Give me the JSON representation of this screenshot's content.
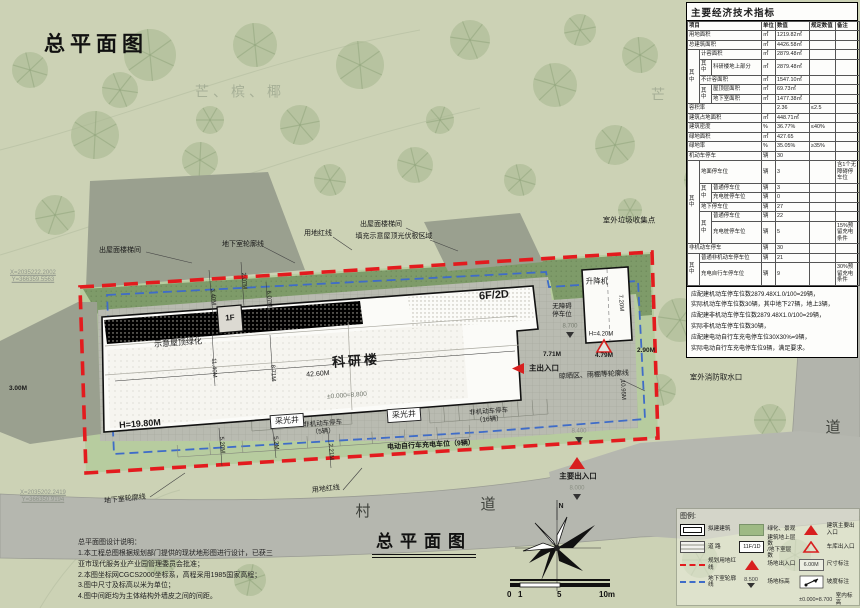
{
  "titles": {
    "top": "总平面图",
    "bottom": "总平面图"
  },
  "colors": {
    "boundary_red": "#e31b1e",
    "basement_blue": "#3f6cc8",
    "marker_red": "#d81f1f",
    "green_band": "#7e9b69",
    "paving_gray": "#b9bbb1"
  },
  "table": {
    "title": "主要经济技术指标",
    "rows": [
      {
        "h": 1,
        "c": [
          {
            "t": "项目",
            "cs": 3
          },
          {
            "t": "单位"
          },
          {
            "t": "数值"
          },
          {
            "t": "规定数值"
          },
          {
            "t": "备注"
          }
        ]
      },
      {
        "c": [
          {
            "t": "用地面积",
            "cs": 3
          },
          {
            "t": "㎡"
          },
          {
            "t": "1219.82㎡"
          },
          {
            "t": ""
          },
          {
            "t": ""
          }
        ]
      },
      {
        "c": [
          {
            "t": "总建筑面积",
            "cs": 3
          },
          {
            "t": "㎡"
          },
          {
            "t": "4426.58㎡"
          },
          {
            "t": ""
          },
          {
            "t": ""
          }
        ]
      },
      {
        "c": [
          {
            "t": "其中",
            "rs": 5
          },
          {
            "t": "计容面积",
            "cs": 2
          },
          {
            "t": "㎡"
          },
          {
            "t": "2879.48㎡"
          },
          {
            "t": ""
          },
          {
            "t": ""
          }
        ]
      },
      {
        "c": [
          {
            "t": "其中"
          },
          {
            "t": "科研楼地上部分"
          },
          {
            "t": "㎡"
          },
          {
            "t": "2879.48㎡"
          },
          {
            "t": ""
          },
          {
            "t": ""
          }
        ]
      },
      {
        "c": [
          {
            "t": "不计容面积",
            "cs": 2
          },
          {
            "t": "㎡"
          },
          {
            "t": "1547.10㎡"
          },
          {
            "t": ""
          },
          {
            "t": ""
          }
        ]
      },
      {
        "c": [
          {
            "t": "其中",
            "rs": 2
          },
          {
            "t": "屋顶层面积"
          },
          {
            "t": "㎡"
          },
          {
            "t": "69.73㎡"
          },
          {
            "t": ""
          },
          {
            "t": ""
          }
        ]
      },
      {
        "c": [
          {
            "t": "地下室面积"
          },
          {
            "t": "㎡"
          },
          {
            "t": "1477.38㎡"
          },
          {
            "t": ""
          },
          {
            "t": ""
          }
        ]
      },
      {
        "c": [
          {
            "t": "容积率",
            "cs": 3
          },
          {
            "t": ""
          },
          {
            "t": "2.36"
          },
          {
            "t": "≤2.5"
          },
          {
            "t": ""
          }
        ]
      },
      {
        "c": [
          {
            "t": "建筑占地面积",
            "cs": 3
          },
          {
            "t": "㎡"
          },
          {
            "t": "448.71㎡"
          },
          {
            "t": ""
          },
          {
            "t": ""
          }
        ]
      },
      {
        "c": [
          {
            "t": "建筑密度",
            "cs": 3
          },
          {
            "t": "%"
          },
          {
            "t": "36.77%"
          },
          {
            "t": "≤40%"
          },
          {
            "t": ""
          }
        ]
      },
      {
        "c": [
          {
            "t": "绿地面积",
            "cs": 3
          },
          {
            "t": "㎡"
          },
          {
            "t": "427.65"
          },
          {
            "t": ""
          },
          {
            "t": ""
          }
        ]
      },
      {
        "c": [
          {
            "t": "绿地率",
            "cs": 3
          },
          {
            "t": "%"
          },
          {
            "t": "35.05%"
          },
          {
            "t": "≥35%"
          },
          {
            "t": ""
          }
        ]
      },
      {
        "c": [
          {
            "t": "机动车停车",
            "cs": 3
          },
          {
            "t": "辆"
          },
          {
            "t": "30"
          },
          {
            "t": ""
          },
          {
            "t": ""
          }
        ]
      },
      {
        "c": [
          {
            "t": "其中",
            "rs": 6
          },
          {
            "t": "地面停车位",
            "cs": 2
          },
          {
            "t": "辆"
          },
          {
            "t": "3"
          },
          {
            "t": ""
          },
          {
            "t": "含1个无障碍停车位"
          }
        ]
      },
      {
        "c": [
          {
            "t": "其中",
            "rs": 2
          },
          {
            "t": "普通停车位"
          },
          {
            "t": "辆"
          },
          {
            "t": "3"
          },
          {
            "t": ""
          },
          {
            "t": ""
          }
        ]
      },
      {
        "c": [
          {
            "t": "充电桩停车位"
          },
          {
            "t": "辆"
          },
          {
            "t": "0"
          },
          {
            "t": ""
          },
          {
            "t": ""
          }
        ]
      },
      {
        "c": [
          {
            "t": "地下停车位",
            "cs": 2
          },
          {
            "t": "辆"
          },
          {
            "t": "27"
          },
          {
            "t": ""
          },
          {
            "t": ""
          }
        ]
      },
      {
        "c": [
          {
            "t": "其中",
            "rs": 2
          },
          {
            "t": "普通停车位"
          },
          {
            "t": "辆"
          },
          {
            "t": "22"
          },
          {
            "t": ""
          },
          {
            "t": ""
          }
        ]
      },
      {
        "c": [
          {
            "t": "充电桩停车位"
          },
          {
            "t": "辆"
          },
          {
            "t": "5"
          },
          {
            "t": ""
          },
          {
            "t": "15%预留充电条件"
          }
        ]
      },
      {
        "c": [
          {
            "t": "非机动车停车",
            "cs": 3
          },
          {
            "t": "辆"
          },
          {
            "t": "30"
          },
          {
            "t": ""
          },
          {
            "t": ""
          }
        ]
      },
      {
        "c": [
          {
            "t": "其中",
            "rs": 2
          },
          {
            "t": "普通非机动车停车位",
            "cs": 2
          },
          {
            "t": "辆"
          },
          {
            "t": "21"
          },
          {
            "t": ""
          },
          {
            "t": ""
          }
        ]
      },
      {
        "c": [
          {
            "t": "充电自行车停车位",
            "cs": 2
          },
          {
            "t": "辆"
          },
          {
            "t": "9"
          },
          {
            "t": ""
          },
          {
            "t": "30%预留充电条件"
          }
        ]
      }
    ],
    "notes": [
      "应配建机动车停车位数2879.48X1.0/100=29辆，",
      "实际机动车停车位数30辆，其中地下27辆，地上3辆，",
      "应配建非机动车停车位数2879.48X1.0/100=29辆，",
      "实际非机动车停车位数30辆，",
      "应配建电动自行车充电停车位30X30%=9辆，",
      "实际电动自行车充电停车位9辆，满足要求。"
    ]
  },
  "design_notes": {
    "title": "总平面图设计说明：",
    "lines": [
      "1.本工程总图根据规划部门提供的现状地形图进行设计，已获三",
      "亚市现代服务业产业园管理委员会批准；",
      "2.本图坐标网CGCS2000坐标系，高程采用1985国家高程；",
      "3.图中尺寸及标高以米为单位；",
      "4.图中间距均为主体结构外墙皮之间的间距。"
    ]
  },
  "legend": {
    "title": "图例:",
    "items": [
      {
        "col": 0,
        "name": "proposed-building",
        "type": "building",
        "label": "拟建建筑"
      },
      {
        "col": 0,
        "name": "road",
        "type": "road",
        "label": "道  路"
      },
      {
        "col": 0,
        "name": "planning-red-line",
        "type": "redline",
        "label": "规划用地红线"
      },
      {
        "col": 0,
        "name": "basement-outline",
        "type": "blueline",
        "label": "地下室轮廓线"
      },
      {
        "col": 1,
        "name": "greening",
        "type": "green",
        "label": "绿化、景观"
      },
      {
        "col": 1,
        "name": "floor-count",
        "type": "floors",
        "text": "11F/1D",
        "label": "建筑地上层数\n/地下室层数"
      },
      {
        "col": 1,
        "name": "site-entrance",
        "type": "tri-solid",
        "label": "场地出入口"
      },
      {
        "col": 1,
        "name": "site-elevation",
        "type": "elev",
        "text": "8.500",
        "label": "场地标高"
      },
      {
        "col": 2,
        "name": "building-main-entrance",
        "type": "tri-solid",
        "label": "建筑主要出入口"
      },
      {
        "col": 2,
        "name": "garage-entrance",
        "type": "tri-open",
        "label": "车库出入口"
      },
      {
        "col": 2,
        "name": "dimension",
        "type": "dim",
        "text": "6.00M",
        "label": "尺寸标注"
      },
      {
        "col": 2,
        "name": "slope",
        "type": "slope",
        "label": "坡度标注"
      },
      {
        "col": 2,
        "name": "indoor-elevation",
        "type": "indoor-elev",
        "text": "±0.000=8.700",
        "label": "室内标高"
      }
    ]
  },
  "scalebar": {
    "labels": [
      "0",
      "1",
      "5",
      "10m"
    ]
  },
  "plan": {
    "labels": [
      {
        "name": "building-name",
        "t": "科研楼",
        "x": 356,
        "y": 361,
        "r": -4,
        "s": 13,
        "b": 1,
        "ls": 3
      },
      {
        "name": "dim-42-60m",
        "t": "42.60M",
        "x": 318,
        "y": 375,
        "r": -4,
        "s": 7
      },
      {
        "name": "elev-main",
        "t": "±0.000=8.800",
        "x": 347,
        "y": 396,
        "r": -4,
        "s": 6.5,
        "col": "#6f746a"
      },
      {
        "name": "height-main",
        "t": "H=19.80M",
        "x": 140,
        "y": 424,
        "r": -4,
        "s": 9,
        "b": 1
      },
      {
        "name": "floors-1f",
        "t": "1F",
        "x": 230,
        "y": 318,
        "r": -4,
        "s": 8,
        "b": 1
      },
      {
        "name": "floors-6f2d",
        "t": "6F/2D",
        "x": 494,
        "y": 296,
        "r": -4,
        "s": 11,
        "b": 1
      },
      {
        "name": "roof-greening",
        "t": "示意屋顶绿化",
        "x": 178,
        "y": 343,
        "r": -4,
        "s": 8
      },
      {
        "name": "lightwell-1",
        "t": "采光井",
        "x": 287,
        "y": 421,
        "r": -4,
        "s": 8,
        "box": 1
      },
      {
        "name": "lightwell-2",
        "t": "采光井",
        "x": 404,
        "y": 415,
        "r": -4,
        "s": 8,
        "box": 1
      },
      {
        "name": "bike-parking-5",
        "t": "非机动车停车\n（5辆）",
        "x": 323,
        "y": 428,
        "r": -4,
        "s": 6.5
      },
      {
        "name": "bike-parking-16",
        "t": "非机动车停车\n（16辆）",
        "x": 489,
        "y": 416,
        "r": -4,
        "s": 6.5
      },
      {
        "name": "ebike-charging",
        "t": "电动自行车充电车位（9辆）",
        "x": 431,
        "y": 446,
        "r": -3,
        "s": 7,
        "b": 1
      },
      {
        "name": "main-entrance-label",
        "t": "主出入口",
        "x": 544,
        "y": 368,
        "s": 7.5,
        "b": 1
      },
      {
        "name": "dim-7-71m",
        "t": "7.71M",
        "x": 552,
        "y": 355,
        "s": 6.5,
        "b": 1
      },
      {
        "name": "drying-area",
        "t": "晾晒区、雨棚等轮廓线",
        "x": 594,
        "y": 376,
        "r": -3,
        "s": 7
      },
      {
        "name": "accessible-parking",
        "t": "无障碍\n停车位",
        "x": 562,
        "y": 311,
        "s": 6.5
      },
      {
        "name": "lift-label",
        "t": "升降机",
        "x": 597,
        "y": 281,
        "s": 7.5
      },
      {
        "name": "dim-7-20m",
        "t": "7.20M",
        "x": 620,
        "y": 303,
        "r": 86,
        "s": 6
      },
      {
        "name": "height-lift",
        "t": "H=4.20M",
        "x": 601,
        "y": 335,
        "s": 6
      },
      {
        "name": "elev-8700",
        "t": "8.700",
        "x": 570,
        "y": 327,
        "s": 6,
        "col": "#777c70"
      },
      {
        "name": "dim-4-79m",
        "t": "4.79M",
        "x": 604,
        "y": 356,
        "s": 6.5,
        "b": 1
      },
      {
        "name": "dim-2-90m",
        "t": "2.90M",
        "x": 646,
        "y": 351,
        "s": 6.5,
        "b": 1
      },
      {
        "name": "dim-10-95m",
        "t": "10.95M",
        "x": 622,
        "y": 390,
        "r": 87,
        "s": 6
      },
      {
        "name": "garbage-point",
        "t": "室外垃圾收集点",
        "x": 629,
        "y": 220,
        "s": 7.5
      },
      {
        "name": "fire-hydrant",
        "t": "室外消防取水口",
        "x": 716,
        "y": 377,
        "s": 7.5
      },
      {
        "name": "roof-stair-1",
        "t": "出屋面楼梯间",
        "x": 120,
        "y": 251,
        "s": 7
      },
      {
        "name": "basement-outline-top",
        "t": "地下室轮廓线",
        "x": 243,
        "y": 245,
        "s": 7
      },
      {
        "name": "red-line-top",
        "t": "用地红线",
        "x": 318,
        "y": 234,
        "s": 7
      },
      {
        "name": "roof-stair-2",
        "t": "出屋面楼梯间",
        "x": 381,
        "y": 225,
        "s": 7
      },
      {
        "name": "pv-area",
        "t": "填充示意屋顶光伏板区域",
        "x": 394,
        "y": 237,
        "s": 7
      },
      {
        "name": "basement-outline-bottom",
        "t": "地下室轮廓线",
        "x": 125,
        "y": 500,
        "r": -6,
        "s": 7
      },
      {
        "name": "red-line-bottom",
        "t": "用地红线",
        "x": 326,
        "y": 490,
        "r": -6,
        "s": 7
      },
      {
        "name": "coord-left",
        "t": "X=2035222.2002\nY=366359.5563",
        "x": 10,
        "y": 277,
        "s": 6,
        "col": "#8f958a",
        "a": "left",
        "u": 1
      },
      {
        "name": "coord-bottom",
        "t": "X=2035202.2419\nY=366350.9194",
        "x": 20,
        "y": 497,
        "s": 6,
        "col": "#8f958a",
        "a": "left",
        "u": 1
      },
      {
        "name": "dim-3-00m",
        "t": "3.00M",
        "x": 18,
        "y": 389,
        "s": 6.5,
        "b": 1
      },
      {
        "name": "dim-3-40m",
        "t": "3.40M",
        "x": 212,
        "y": 297,
        "r": 85,
        "s": 6
      },
      {
        "name": "dim-2-07m",
        "t": "2.07M",
        "x": 243,
        "y": 281,
        "r": 85,
        "s": 6
      },
      {
        "name": "dim-6-07m",
        "t": "6.07M",
        "x": 268,
        "y": 299,
        "r": 85,
        "s": 6
      },
      {
        "name": "dim-11-40m",
        "t": "11.40M",
        "x": 213,
        "y": 368,
        "r": 87,
        "s": 6
      },
      {
        "name": "dim-8-71m",
        "t": "8.71M",
        "x": 272,
        "y": 373,
        "r": 87,
        "s": 6
      },
      {
        "name": "dim-5-20m-a",
        "t": "5.20M",
        "x": 221,
        "y": 445,
        "r": 85,
        "s": 6
      },
      {
        "name": "dim-5-20m-b",
        "t": "5.2M",
        "x": 275,
        "y": 443,
        "r": 85,
        "s": 6
      },
      {
        "name": "dim-2-21m",
        "t": "2.21M",
        "x": 330,
        "y": 452,
        "r": 85,
        "s": 6
      },
      {
        "name": "main-exit-label",
        "t": "主要出入口",
        "x": 578,
        "y": 476,
        "s": 7.5,
        "b": 1
      },
      {
        "name": "elev-8400",
        "t": "8.400",
        "x": 579,
        "y": 432,
        "s": 6,
        "col": "#8a8f83"
      },
      {
        "name": "elev-8000",
        "t": "8.000",
        "x": 577,
        "y": 489,
        "s": 6,
        "col": "#8a8f83"
      },
      {
        "name": "north-letter",
        "t": "N",
        "x": 561,
        "y": 507,
        "s": 7,
        "b": 1
      },
      {
        "name": "road-name-bottom-1",
        "t": "村",
        "x": 363,
        "y": 512,
        "s": 15,
        "col": "#3f423c"
      },
      {
        "name": "road-name-bottom-2",
        "t": "道",
        "x": 488,
        "y": 505,
        "s": 15,
        "col": "#3f423c"
      },
      {
        "name": "road-name-right-1",
        "t": "村",
        "x": 831,
        "y": 350,
        "s": 15,
        "col": "#3f423c"
      },
      {
        "name": "road-name-right-2",
        "t": "道",
        "x": 833,
        "y": 428,
        "s": 15,
        "col": "#3f423c"
      },
      {
        "name": "watermark-trees",
        "t": "芒、槟、椰",
        "x": 240,
        "y": 92,
        "s": 14,
        "col": "rgba(140,152,130,0.6)",
        "ls": 4
      },
      {
        "name": "watermark-mang",
        "t": "芒",
        "x": 658,
        "y": 95,
        "s": 14,
        "col": "rgba(140,152,130,0.6)"
      }
    ]
  }
}
